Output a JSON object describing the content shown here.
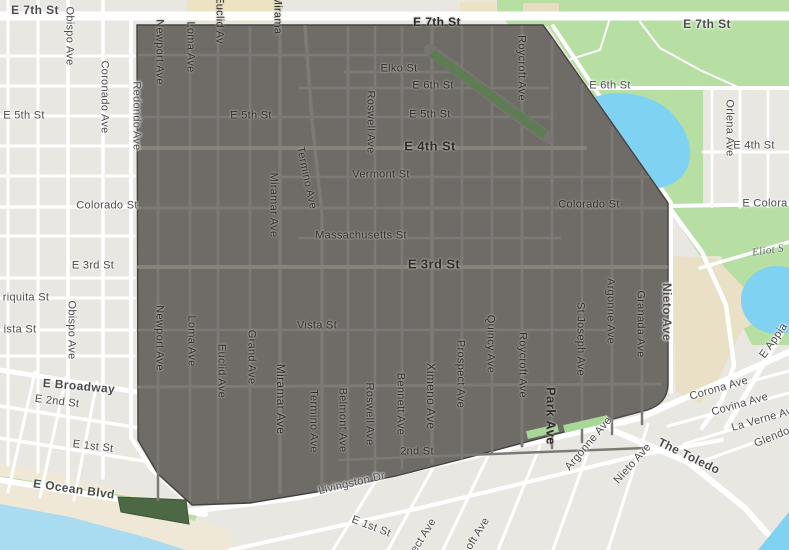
{
  "map": {
    "description": "street map with highlighted neighborhood polygon",
    "colors": {
      "selection_fill": "#6f6c68",
      "selection_outline": "#45423f",
      "selection_street": "#7d7a76",
      "road": "#ffffff",
      "block": "#e9e7e2",
      "park": "#b7dfa4",
      "pond": "#7fd2f2",
      "ocean": "#a9dcf1",
      "sand": "#efe8d6",
      "greenbelt_in_selection": "#5e7d55",
      "beach_park_in_selection": "#4d6845",
      "school_beige": "#ece3c2",
      "golf_beige": "#e9e0c5",
      "label_outside": "#4c4c4c",
      "label_on_selection": "#2f2c29"
    },
    "labels": [
      {
        "t": "E 7th St",
        "x": 35,
        "y": 10,
        "s": 12,
        "c": "out",
        "b": 1
      },
      {
        "t": "E 7th St",
        "x": 437,
        "y": 22,
        "s": 12,
        "c": "poly",
        "b": 1
      },
      {
        "t": "E 7th St",
        "x": 707,
        "y": 24,
        "s": 12,
        "c": "out",
        "b": 1
      },
      {
        "t": "E 5th St",
        "x": 24,
        "y": 116,
        "c": "out"
      },
      {
        "t": "E 5th St",
        "x": 251,
        "y": 116,
        "c": "poly"
      },
      {
        "t": "Elko St",
        "x": 399,
        "y": 69,
        "c": "poly"
      },
      {
        "t": "E 6th St",
        "x": 433,
        "y": 86,
        "c": "poly"
      },
      {
        "t": "E 6th St",
        "x": 610,
        "y": 86,
        "c": "out"
      },
      {
        "t": "E 5th St",
        "x": 430,
        "y": 115,
        "c": "poly"
      },
      {
        "t": "E 4th St",
        "x": 430,
        "y": 146,
        "s": 13,
        "c": "poly",
        "b": 1
      },
      {
        "t": "E 4th St",
        "x": 754,
        "y": 146,
        "c": "out"
      },
      {
        "t": "Vermont St",
        "x": 381,
        "y": 175,
        "c": "poly"
      },
      {
        "t": "Colorado St",
        "x": 107,
        "y": 206,
        "c": "out"
      },
      {
        "t": "Colorado St",
        "x": 589,
        "y": 205,
        "c": "poly"
      },
      {
        "t": "E Colora",
        "x": 765,
        "y": 204,
        "c": "out"
      },
      {
        "t": "Massachusetts St",
        "x": 361,
        "y": 236,
        "c": "poly"
      },
      {
        "t": "E 3rd St",
        "x": 93,
        "y": 266,
        "c": "out"
      },
      {
        "t": "E 3rd St",
        "x": 434,
        "y": 264,
        "s": 13,
        "c": "poly",
        "b": 1
      },
      {
        "t": "riquita St",
        "x": 26,
        "y": 298,
        "c": "out"
      },
      {
        "t": "ista St",
        "x": 20,
        "y": 330,
        "c": "out"
      },
      {
        "t": "Vista St",
        "x": 317,
        "y": 326,
        "c": "poly"
      },
      {
        "t": "E Broadway",
        "x": 79,
        "y": 386,
        "r": 5,
        "s": 12,
        "c": "out",
        "b": 1
      },
      {
        "t": "E 2nd St",
        "x": 57,
        "y": 402,
        "r": 7,
        "c": "out"
      },
      {
        "t": "E 1st St",
        "x": 93,
        "y": 447,
        "r": 7,
        "c": "out"
      },
      {
        "t": "E Ocean Blvd",
        "x": 74,
        "y": 489,
        "r": 8,
        "s": 12,
        "c": "out",
        "b": 1
      },
      {
        "t": "2nd St",
        "x": 417,
        "y": 452,
        "c": "poly"
      },
      {
        "t": "Livingston Dr",
        "x": 352,
        "y": 484,
        "r": -13,
        "c": "out"
      },
      {
        "t": "E 1st St",
        "x": 371,
        "y": 527,
        "r": 21,
        "c": "out"
      },
      {
        "t": "Eliot S",
        "x": 768,
        "y": 251,
        "r": -8,
        "c": "wtr"
      },
      {
        "t": "The Toledo",
        "x": 689,
        "y": 456,
        "r": 26,
        "s": 12,
        "c": "out",
        "b": 1
      },
      {
        "t": "Corona Ave",
        "x": 719,
        "y": 389,
        "r": -16,
        "c": "out"
      },
      {
        "t": "Covina Ave",
        "x": 740,
        "y": 405,
        "r": -16,
        "c": "out"
      },
      {
        "t": "La Verne Av",
        "x": 762,
        "y": 420,
        "r": -16,
        "c": "out"
      },
      {
        "t": "Glendor",
        "x": 774,
        "y": 437,
        "r": -22,
        "c": "out"
      },
      {
        "t": "E Appia",
        "x": 774,
        "y": 341,
        "r": -55,
        "c": "out"
      },
      {
        "t": "ect Ave",
        "x": 424,
        "y": 536,
        "r": -58,
        "c": "out"
      },
      {
        "t": "oft Ave",
        "x": 478,
        "y": 534,
        "r": -58,
        "c": "out"
      },
      {
        "t": "Argonne Ave",
        "x": 589,
        "y": 444,
        "r": -50,
        "c": "out"
      },
      {
        "t": "Nieto Ave",
        "x": 633,
        "y": 464,
        "r": -48,
        "c": "out"
      },
      {
        "t": "Nieto Ave",
        "x": 667,
        "y": 312,
        "r": 90,
        "s": 12,
        "c": "out",
        "b": 1
      },
      {
        "t": "Obispo Ave",
        "x": 69,
        "y": 36,
        "r": 90,
        "c": "out"
      },
      {
        "t": "Obispo Ave",
        "x": 71,
        "y": 330,
        "r": 90,
        "c": "out"
      },
      {
        "t": "Coronado Ave",
        "x": 104,
        "y": 97,
        "r": 90,
        "c": "out"
      },
      {
        "t": "Redondo Ave",
        "x": 136,
        "y": 116,
        "r": 90,
        "c": "out"
      },
      {
        "t": "Orlena Ave",
        "x": 729,
        "y": 128,
        "r": 90,
        "c": "out"
      },
      {
        "t": "Newport Ave",
        "x": 159,
        "y": 52,
        "r": 90,
        "c": "poly"
      },
      {
        "t": "Newport Ave",
        "x": 159,
        "y": 338,
        "r": 90,
        "c": "poly"
      },
      {
        "t": "Loma Ave",
        "x": 190,
        "y": 47,
        "r": 90,
        "c": "poly"
      },
      {
        "t": "Loma Ave",
        "x": 191,
        "y": 341,
        "r": 90,
        "c": "poly"
      },
      {
        "t": "Euclid Av",
        "x": 219,
        "y": 20,
        "r": 90,
        "c": "poly"
      },
      {
        "t": "Euclid Ave",
        "x": 221,
        "y": 371,
        "r": 90,
        "c": "poly"
      },
      {
        "t": "Grand Ave",
        "x": 251,
        "y": 357,
        "r": 90,
        "c": "poly"
      },
      {
        "t": "Mirama",
        "x": 277,
        "y": 15,
        "r": 90,
        "c": "poly"
      },
      {
        "t": "Miramar Ave",
        "x": 273,
        "y": 205,
        "r": 90,
        "c": "poly"
      },
      {
        "t": "Miramar Ave",
        "x": 281,
        "y": 399,
        "r": 90,
        "s": 12,
        "c": "poly"
      },
      {
        "t": "Termino Ave",
        "x": 306,
        "y": 178,
        "r": 78,
        "c": "poly"
      },
      {
        "t": "Termino Ave",
        "x": 313,
        "y": 421,
        "r": 90,
        "c": "poly"
      },
      {
        "t": "Roswell Ave",
        "x": 370,
        "y": 122,
        "r": 90,
        "c": "poly"
      },
      {
        "t": "Roswell Ave",
        "x": 369,
        "y": 414,
        "r": 90,
        "c": "poly"
      },
      {
        "t": "Belmont Ave",
        "x": 342,
        "y": 420,
        "r": 90,
        "c": "poly"
      },
      {
        "t": "Bennett Ave",
        "x": 400,
        "y": 404,
        "r": 90,
        "c": "poly"
      },
      {
        "t": "Ximeno Ave",
        "x": 431,
        "y": 396,
        "r": 90,
        "s": 12,
        "c": "poly"
      },
      {
        "t": "Prospect Ave",
        "x": 460,
        "y": 374,
        "r": 90,
        "c": "poly"
      },
      {
        "t": "Quincy Ave",
        "x": 490,
        "y": 344,
        "r": 90,
        "c": "poly"
      },
      {
        "t": "Roycroft Ave",
        "x": 521,
        "y": 68,
        "r": 90,
        "c": "poly"
      },
      {
        "t": "Roycroft Ave",
        "x": 522,
        "y": 365,
        "r": 90,
        "c": "poly"
      },
      {
        "t": "Park Ave",
        "x": 551,
        "y": 416,
        "r": 90,
        "s": 13,
        "c": "poly",
        "b": 1
      },
      {
        "t": "St Joseph Ave",
        "x": 580,
        "y": 339,
        "r": 90,
        "c": "poly"
      },
      {
        "t": "Argonne Ave",
        "x": 610,
        "y": 311,
        "r": 90,
        "c": "poly"
      },
      {
        "t": "Granada Ave",
        "x": 640,
        "y": 324,
        "r": 90,
        "c": "poly"
      }
    ]
  }
}
